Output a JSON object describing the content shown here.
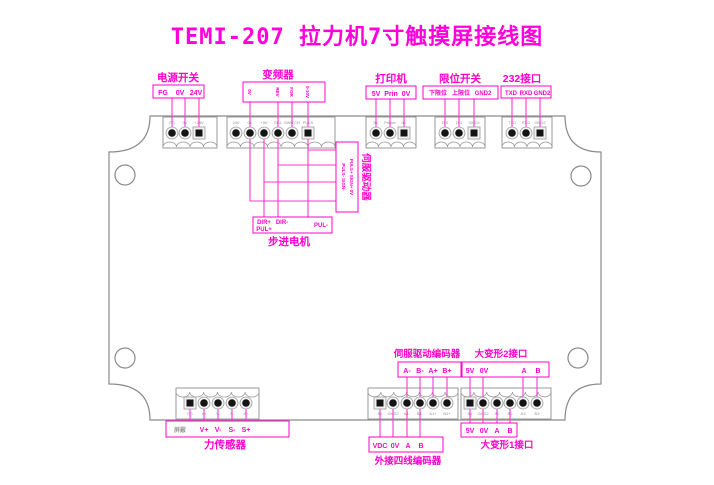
{
  "title": "TEMI-207 拉力机7寸触摸屏接线图",
  "colors": {
    "magenta": "#ff00cc",
    "wire": "#ff36d2",
    "board_outline": "#8a8a8a"
  },
  "sections": {
    "power": {
      "title": "电源开关",
      "pins": [
        "FG",
        "0V",
        "24V"
      ],
      "strip": [
        "FG",
        "0V",
        "+24V"
      ]
    },
    "inverter": {
      "title": "变频器",
      "pins": [
        "0V",
        "REV",
        "FOR",
        "0-10V"
      ],
      "strip": [
        "24V",
        "0V",
        "+5V",
        "SIN-",
        "SWITCH",
        "PULS"
      ]
    },
    "printer": {
      "title": "打印机",
      "pins": [
        "5V",
        "Prin",
        "0V"
      ],
      "strip": [
        "5V",
        "Printer",
        "0V"
      ]
    },
    "limit": {
      "title": "限位开关",
      "pins": [
        "下限位",
        "上限位",
        "GND2"
      ],
      "strip": [
        "DI0",
        "DI1",
        "GND2"
      ]
    },
    "rs232": {
      "title": "232接口",
      "pins": [
        "TXD",
        "RXD",
        "GND2"
      ],
      "strip": [
        "TXD",
        "RXD",
        "GND2"
      ]
    },
    "servo_driver": {
      "title": "伺服驱动器",
      "line1": "PULS-  SIGN-",
      "line2": "PULS+  SIGN+  0V"
    },
    "stepper": {
      "title": "步进电机",
      "pins": [
        "DIR+",
        "PUL+",
        "DIR-",
        "PUL-"
      ]
    },
    "force": {
      "title": "力传感器",
      "pins": [
        "屏蔽",
        "V+",
        "V-",
        "S-",
        "S+"
      ],
      "strip": [
        "FG",
        "V+",
        "V-",
        "S-",
        "S+"
      ]
    },
    "servo_encoder": {
      "title": "伺服驱动编码器",
      "pins": [
        "A-",
        "B-",
        "A+",
        "B+"
      ],
      "strip": [
        "5V",
        "GND2",
        "A1-",
        "B1-",
        "A1+",
        "B1+"
      ]
    },
    "ext_encoder": {
      "title": "外接四线编码器",
      "pins": [
        "VDC",
        "0V",
        "A",
        "B"
      ]
    },
    "deform2": {
      "title": "大变形2接口",
      "pins": [
        "5V",
        "0V",
        "A",
        "B"
      ],
      "strip": [
        "5V",
        "GND2",
        "A2",
        "B2",
        "A3",
        "B3"
      ]
    },
    "deform1": {
      "title": "大变形1接口",
      "pins": [
        "5V",
        "0V",
        "A",
        "B"
      ]
    }
  }
}
